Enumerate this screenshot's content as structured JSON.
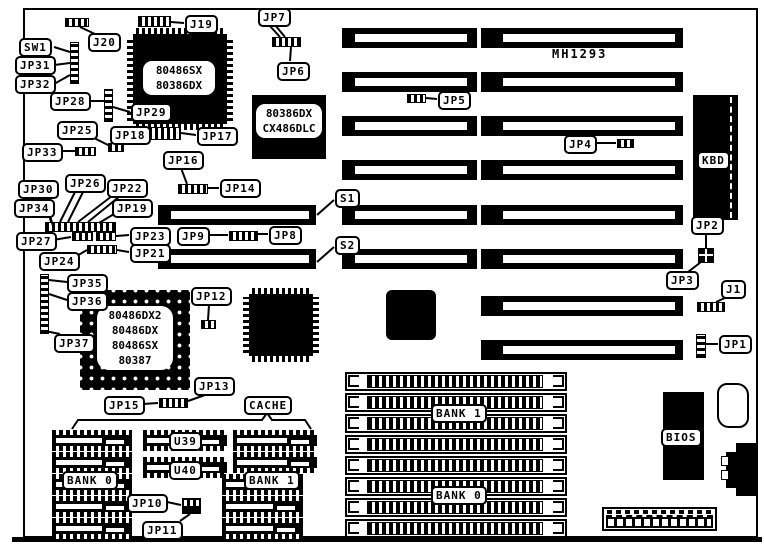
{
  "title": "MH1293",
  "chips": {
    "qfp_cpu_lines": [
      "80486SX",
      "80386DX"
    ],
    "copro_lines": [
      "80386DX",
      "CX486DLC"
    ],
    "pga_lines": [
      "80486DX2",
      "80486DX",
      "80486SX",
      "80387"
    ]
  },
  "callouts": [
    {
      "id": "j19",
      "label": "J19"
    },
    {
      "id": "j20",
      "label": "J20"
    },
    {
      "id": "sw1",
      "label": "SW1"
    },
    {
      "id": "jp31",
      "label": "JP31"
    },
    {
      "id": "jp32",
      "label": "JP32"
    },
    {
      "id": "jp28",
      "label": "JP28"
    },
    {
      "id": "jp29",
      "label": "JP29"
    },
    {
      "id": "jp25",
      "label": "JP25"
    },
    {
      "id": "jp33",
      "label": "JP33"
    },
    {
      "id": "jp18",
      "label": "JP18"
    },
    {
      "id": "jp17",
      "label": "JP17"
    },
    {
      "id": "jp16",
      "label": "JP16"
    },
    {
      "id": "jp14",
      "label": "JP14"
    },
    {
      "id": "jp7",
      "label": "JP7"
    },
    {
      "id": "jp6",
      "label": "JP6"
    },
    {
      "id": "jp5",
      "label": "JP5"
    },
    {
      "id": "jp4",
      "label": "JP4"
    },
    {
      "id": "s1",
      "label": "S1"
    },
    {
      "id": "s2",
      "label": "S2"
    },
    {
      "id": "jp30",
      "label": "JP30"
    },
    {
      "id": "jp26",
      "label": "JP26"
    },
    {
      "id": "jp22",
      "label": "JP22"
    },
    {
      "id": "jp34",
      "label": "JP34"
    },
    {
      "id": "jp19",
      "label": "JP19"
    },
    {
      "id": "jp27",
      "label": "JP27"
    },
    {
      "id": "jp23",
      "label": "JP23"
    },
    {
      "id": "jp21",
      "label": "JP21"
    },
    {
      "id": "jp24",
      "label": "JP24"
    },
    {
      "id": "jp9",
      "label": "JP9"
    },
    {
      "id": "jp8",
      "label": "JP8"
    },
    {
      "id": "jp35",
      "label": "JP35"
    },
    {
      "id": "jp36",
      "label": "JP36"
    },
    {
      "id": "jp37",
      "label": "JP37"
    },
    {
      "id": "jp12",
      "label": "JP12"
    },
    {
      "id": "jp15",
      "label": "JP15"
    },
    {
      "id": "jp13",
      "label": "JP13"
    },
    {
      "id": "cache",
      "label": "CACHE"
    },
    {
      "id": "u39",
      "label": "U39"
    },
    {
      "id": "u40",
      "label": "U40"
    },
    {
      "id": "bank0_cache",
      "label": "BANK 0"
    },
    {
      "id": "bank1_cache",
      "label": "BANK 1"
    },
    {
      "id": "jp10",
      "label": "JP10"
    },
    {
      "id": "jp11",
      "label": "JP11"
    },
    {
      "id": "bank1_simm",
      "label": "BANK 1"
    },
    {
      "id": "bank0_simm",
      "label": "BANK 0"
    },
    {
      "id": "kbd",
      "label": "KBD"
    },
    {
      "id": "jp2",
      "label": "JP2"
    },
    {
      "id": "jp3",
      "label": "JP3"
    },
    {
      "id": "j1",
      "label": "J1"
    },
    {
      "id": "jp1",
      "label": "JP1"
    },
    {
      "id": "bios",
      "label": "BIOS"
    }
  ]
}
